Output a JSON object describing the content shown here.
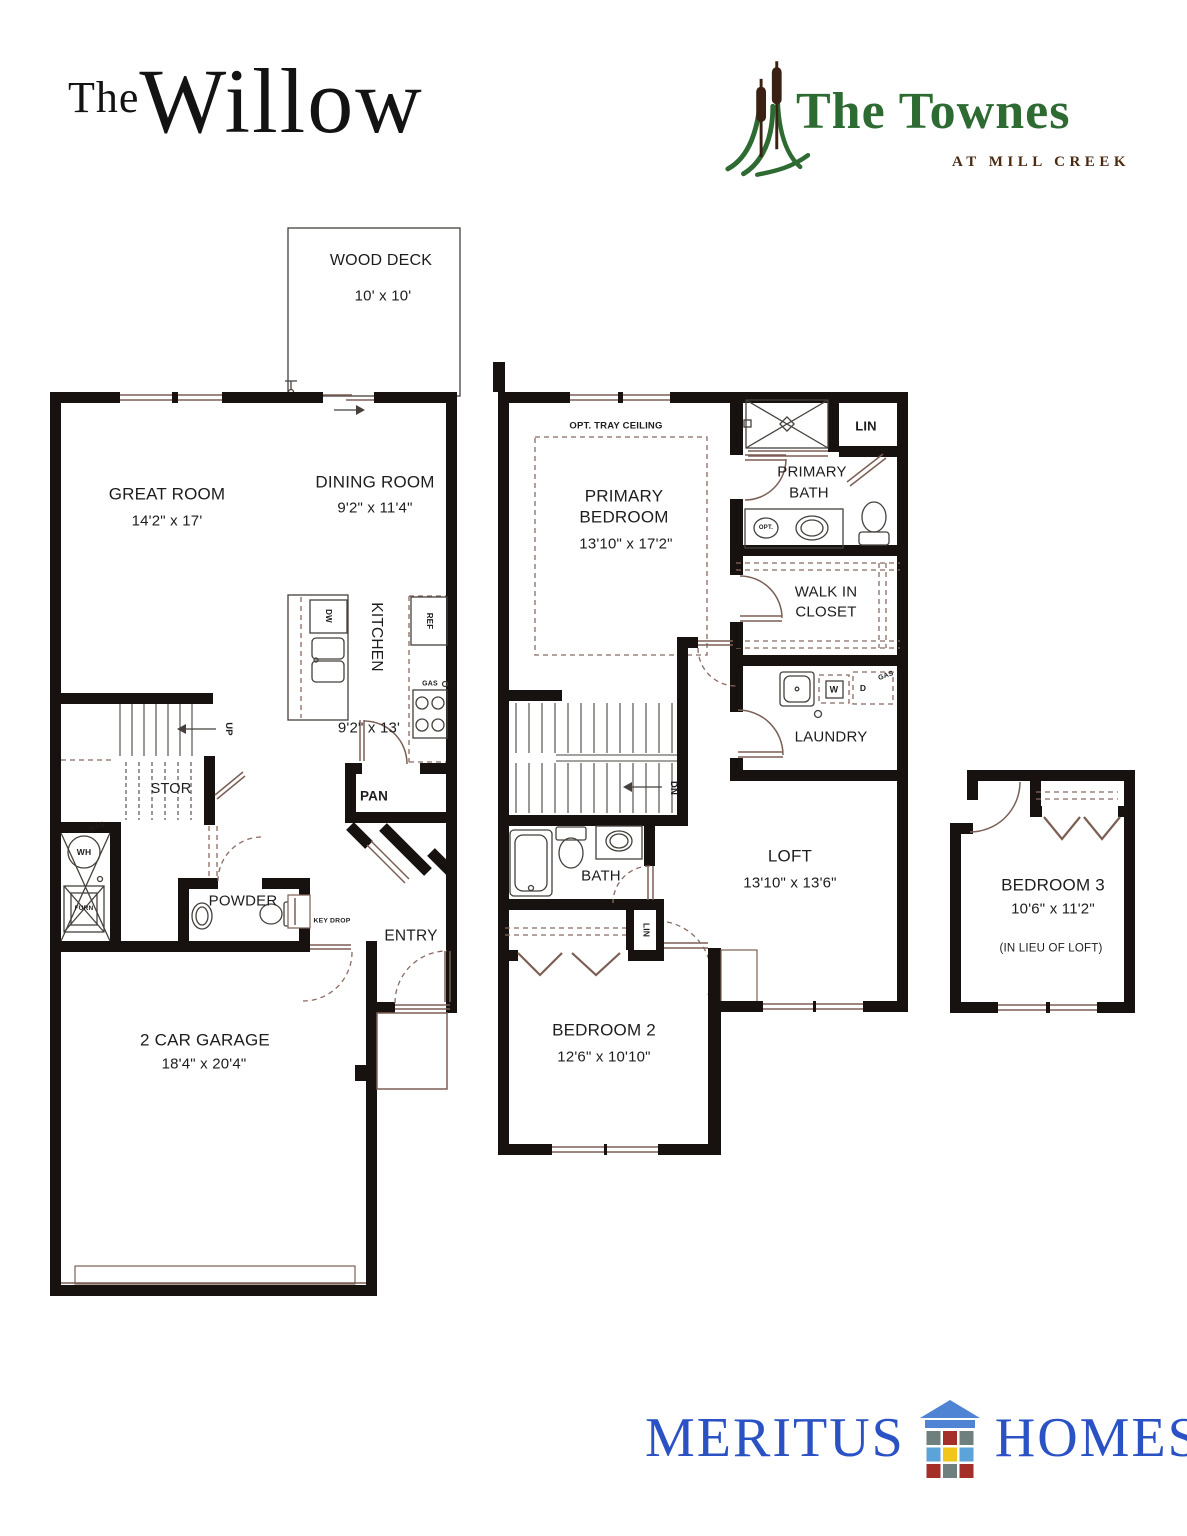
{
  "branding": {
    "plan_prefix": "The",
    "plan_name": "Willow",
    "community_name": "The Townes",
    "community_tagline": "AT MILL CREEK",
    "builder_word1": "MERITUS",
    "builder_word2": "HOMES"
  },
  "colors": {
    "townes_green": "#2d6b33",
    "townes_brown": "#4b2a12",
    "meritus_blue": "#2a52c4",
    "wall_black": "#171210"
  },
  "first_floor": {
    "wood_deck_label": "WOOD D ECK",
    "wood_deck_label_fixed": "WOOD DECK",
    "wood_deck_dims": "10' x 10'",
    "great_room_label": "GREAT ROOM",
    "great_room_dims": "14'2\" x 17'",
    "dining_room_label": "DINING ROOM",
    "dining_room_dims": "9'2\" x 11'4\"",
    "kitchen_label": "KITCHEN",
    "kitchen_dims": "9'2\" x 13'",
    "dishwasher": "DW",
    "refrigerator": "REF",
    "gas_range": "GAS",
    "pantry": "PAN",
    "stairs_up": "UP",
    "storage": "STOR",
    "water_heater": "WH",
    "furnace": "FURN",
    "gas_meter": "GAS",
    "powder": "POWDER",
    "key_drop": "KEY DROP",
    "entry": "ENTRY",
    "garage_label": "2 CAR GARAGE",
    "garage_dims": "18'4\" x 20'4\""
  },
  "second_floor": {
    "tray_ceiling": "OPT. TRAY CEILING",
    "primary_bedroom_line1": "PRIMARY",
    "primary_bedroom_line2": "BEDROOM",
    "primary_bedroom_dims": "13'10\" x 17'2\"",
    "primary_bath_line1": "PRIMARY",
    "primary_bath_line2": "BATH",
    "linen_upper": "LIN",
    "opt_sink": "OPT.",
    "wic_line1": "WALK IN",
    "wic_line2": "CLOSET",
    "laundry": "LAUNDRY",
    "washer": "W",
    "dryer": "D",
    "gas": "GAS",
    "stairs_down": "DN",
    "bath": "BATH",
    "linen_hall": "LIN",
    "loft_label": "LOFT",
    "loft_dims": "13'10\" x 13'6\"",
    "bedroom2_label": "BEDROOM 2",
    "bedroom2_dims": "12'6\" x 10'10\""
  },
  "bedroom3": {
    "label": "BEDROOM 3",
    "dims": "10'6\" x 11'2\"",
    "note": "(IN LIEU OF LOFT)"
  }
}
